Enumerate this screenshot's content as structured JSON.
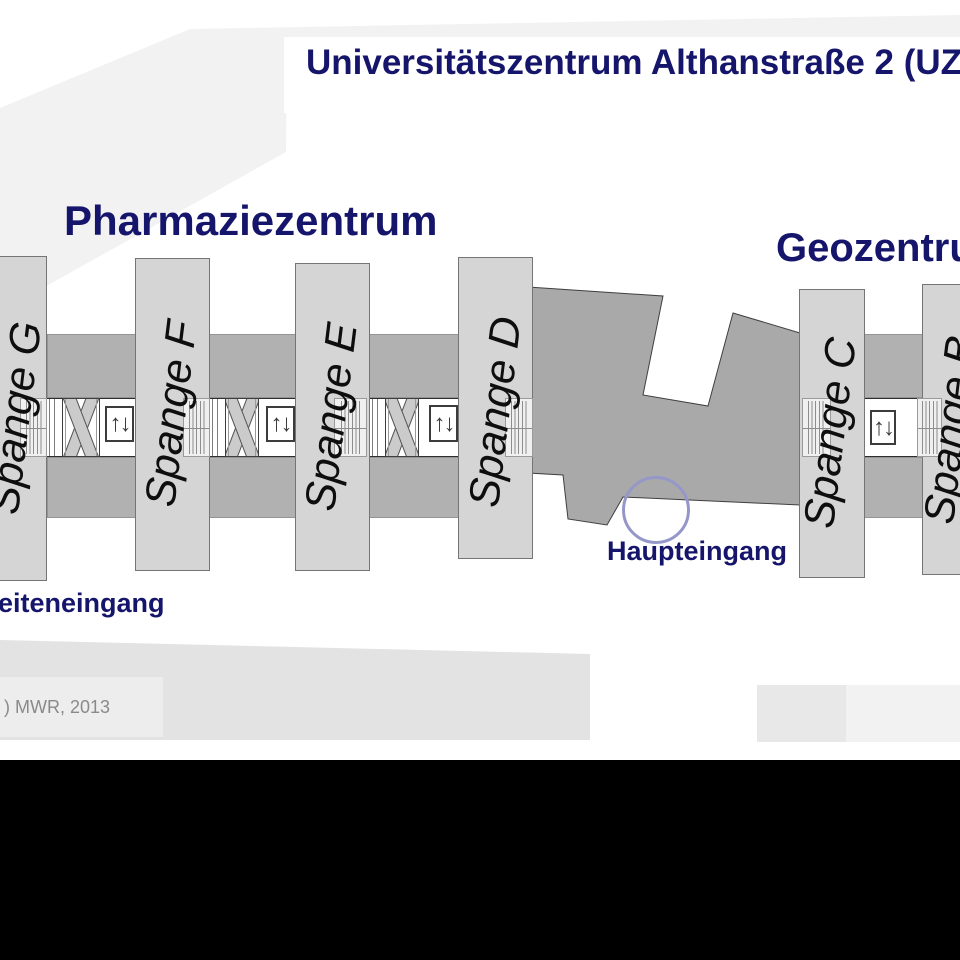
{
  "title": "Universitätszentrum Althanstraße 2 (UZA",
  "areas": {
    "pharmacy": "Pharmaziezentrum",
    "geo": "Geozentrum"
  },
  "buildings": [
    {
      "label": "Spange G"
    },
    {
      "label": "Spange F"
    },
    {
      "label": "Spange E"
    },
    {
      "label": "Spange D"
    },
    {
      "label": "Spange C"
    },
    {
      "label": "Spange B"
    }
  ],
  "entrances": {
    "main": "Haupteingang",
    "side": "Seiteneingang"
  },
  "credit": ") MWR, 2013",
  "icons": {
    "elevator": "↑↓"
  },
  "colors": {
    "heading": "#15156b",
    "building_fill": "#d5d5d5",
    "corridor_fill": "#b1b1b1",
    "hall_fill": "#a9a9a9",
    "entrance_circle": "#9697c9"
  }
}
